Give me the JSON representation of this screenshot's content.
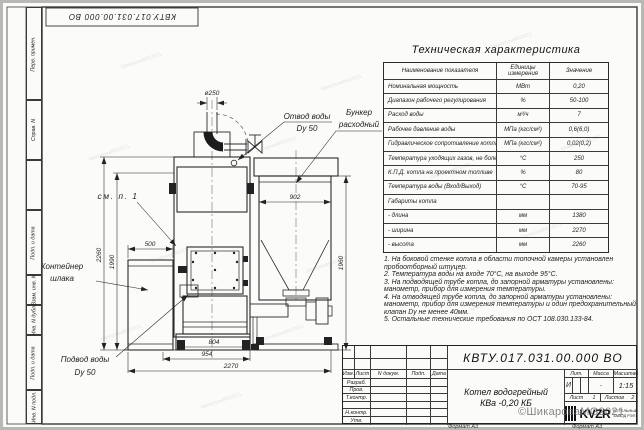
{
  "sheet": {
    "stamp_top": "КВТУ.017.031.00.000  ВО",
    "format_label": "Формат А3",
    "side_labels": [
      "Перв. примен.",
      "Справ. N",
      "Подп. и дата",
      "Взам. инв. N",
      "Инв. N дубл.",
      "Подп. и дата",
      "Инв. N подл."
    ]
  },
  "watermark": {
    "main": "©ШикароваMG2021",
    "tile": "ШикароваMG2021"
  },
  "drawing": {
    "labels": {
      "see_note": "см. п. 1",
      "water_outlet_1": "Отвод воды",
      "water_outlet_2": "Dy 50",
      "bunker_1": "Бункер",
      "bunker_2": "расходный",
      "slag_1": "Контейнер",
      "slag_2": "шлака",
      "water_inlet_1": "Подвод воды",
      "water_inlet_2": "Dy 50"
    },
    "dims": {
      "chimney_d": "ø250",
      "bunker_w": "902",
      "total_h": "2260",
      "body_h": "1990",
      "slag_w": "500",
      "bunker_h": "1960",
      "skid_w": "804",
      "mid_w": "954",
      "total_w": "2270"
    }
  },
  "spec_table": {
    "title": "Техническая характеристика",
    "headers": [
      "Наименование показателя",
      "Единицы измерения",
      "Значение"
    ],
    "rows": [
      {
        "name": "Номинальная мощность",
        "unit": "МВт",
        "value": "0,20"
      },
      {
        "name": "Диапазон рабочего регулирования",
        "unit": "%",
        "value": "50-100"
      },
      {
        "name": "Расход воды",
        "unit": "м³/ч",
        "value": "7"
      },
      {
        "name": "Рабочее давление воды",
        "unit": "МПа (кгс/см²)",
        "value": "0,6(6,0)"
      },
      {
        "name": "Гидравлическое сопротивление котла",
        "unit": "МПа (кгс/см²)",
        "value": "0,02(0,2)"
      },
      {
        "name": "Температура уходящих газов, не более",
        "unit": "°С",
        "value": "250"
      },
      {
        "name": "К.П.Д. котла на проектном топливе",
        "unit": "%",
        "value": "80"
      },
      {
        "name": "Температура воды (Вход/Выход)",
        "unit": "°С",
        "value": "70-95"
      },
      {
        "name": "Габариты котла",
        "unit": "",
        "value": ""
      },
      {
        "name": "- длина",
        "unit": "мм",
        "value": "1380"
      },
      {
        "name": "- ширина",
        "unit": "мм",
        "value": "2270"
      },
      {
        "name": "- высота",
        "unit": "мм",
        "value": "2260"
      }
    ]
  },
  "notes": {
    "lines": [
      "1. На боковой стенке котла в области топочной камеры установлен",
      "пробоотборный штуцер.",
      "2. Температура воды на входе 70°С, на выходе 95°С.",
      "3. На подводящей трубе котла, до запорной арматуры установлены:",
      "манометр, прибор для измерения температуры.",
      "4. На отводящей трубе котла, до запорной арматуры установлены:",
      "манометр, прибор для измерения температуры и один предохранительный",
      "клапан Dy не менее 40мм.",
      "5. Остальные технические требования по ОСТ 108.030.133-84."
    ]
  },
  "title_block": {
    "designation": "КВТУ.017.031.00.000  ВО",
    "name_line1": "Котел водогрейный",
    "name_line2": "КВа -0,20  КБ",
    "cols": [
      "Изм.",
      "Лист",
      "N докум.",
      "Подп.",
      "Дата"
    ],
    "rows": [
      "Разраб.",
      "Пров.",
      "Т.контр.",
      "",
      "Н.контр.",
      "Утв."
    ],
    "lit_h": "Лит.",
    "mass_h": "Масса",
    "scale_h": "Масштаб",
    "lit_v": "И",
    "mass_v": "-",
    "scale_v": "1:15",
    "sheet_h": "Лист",
    "sheet_v": "1",
    "sheets_h": "Листов",
    "sheets_v": "2",
    "logo_text": "KVZR",
    "logo_cap1": "КОТЕЛЬНЫЙ",
    "logo_cap2": "ЗАВОД РЭП"
  }
}
